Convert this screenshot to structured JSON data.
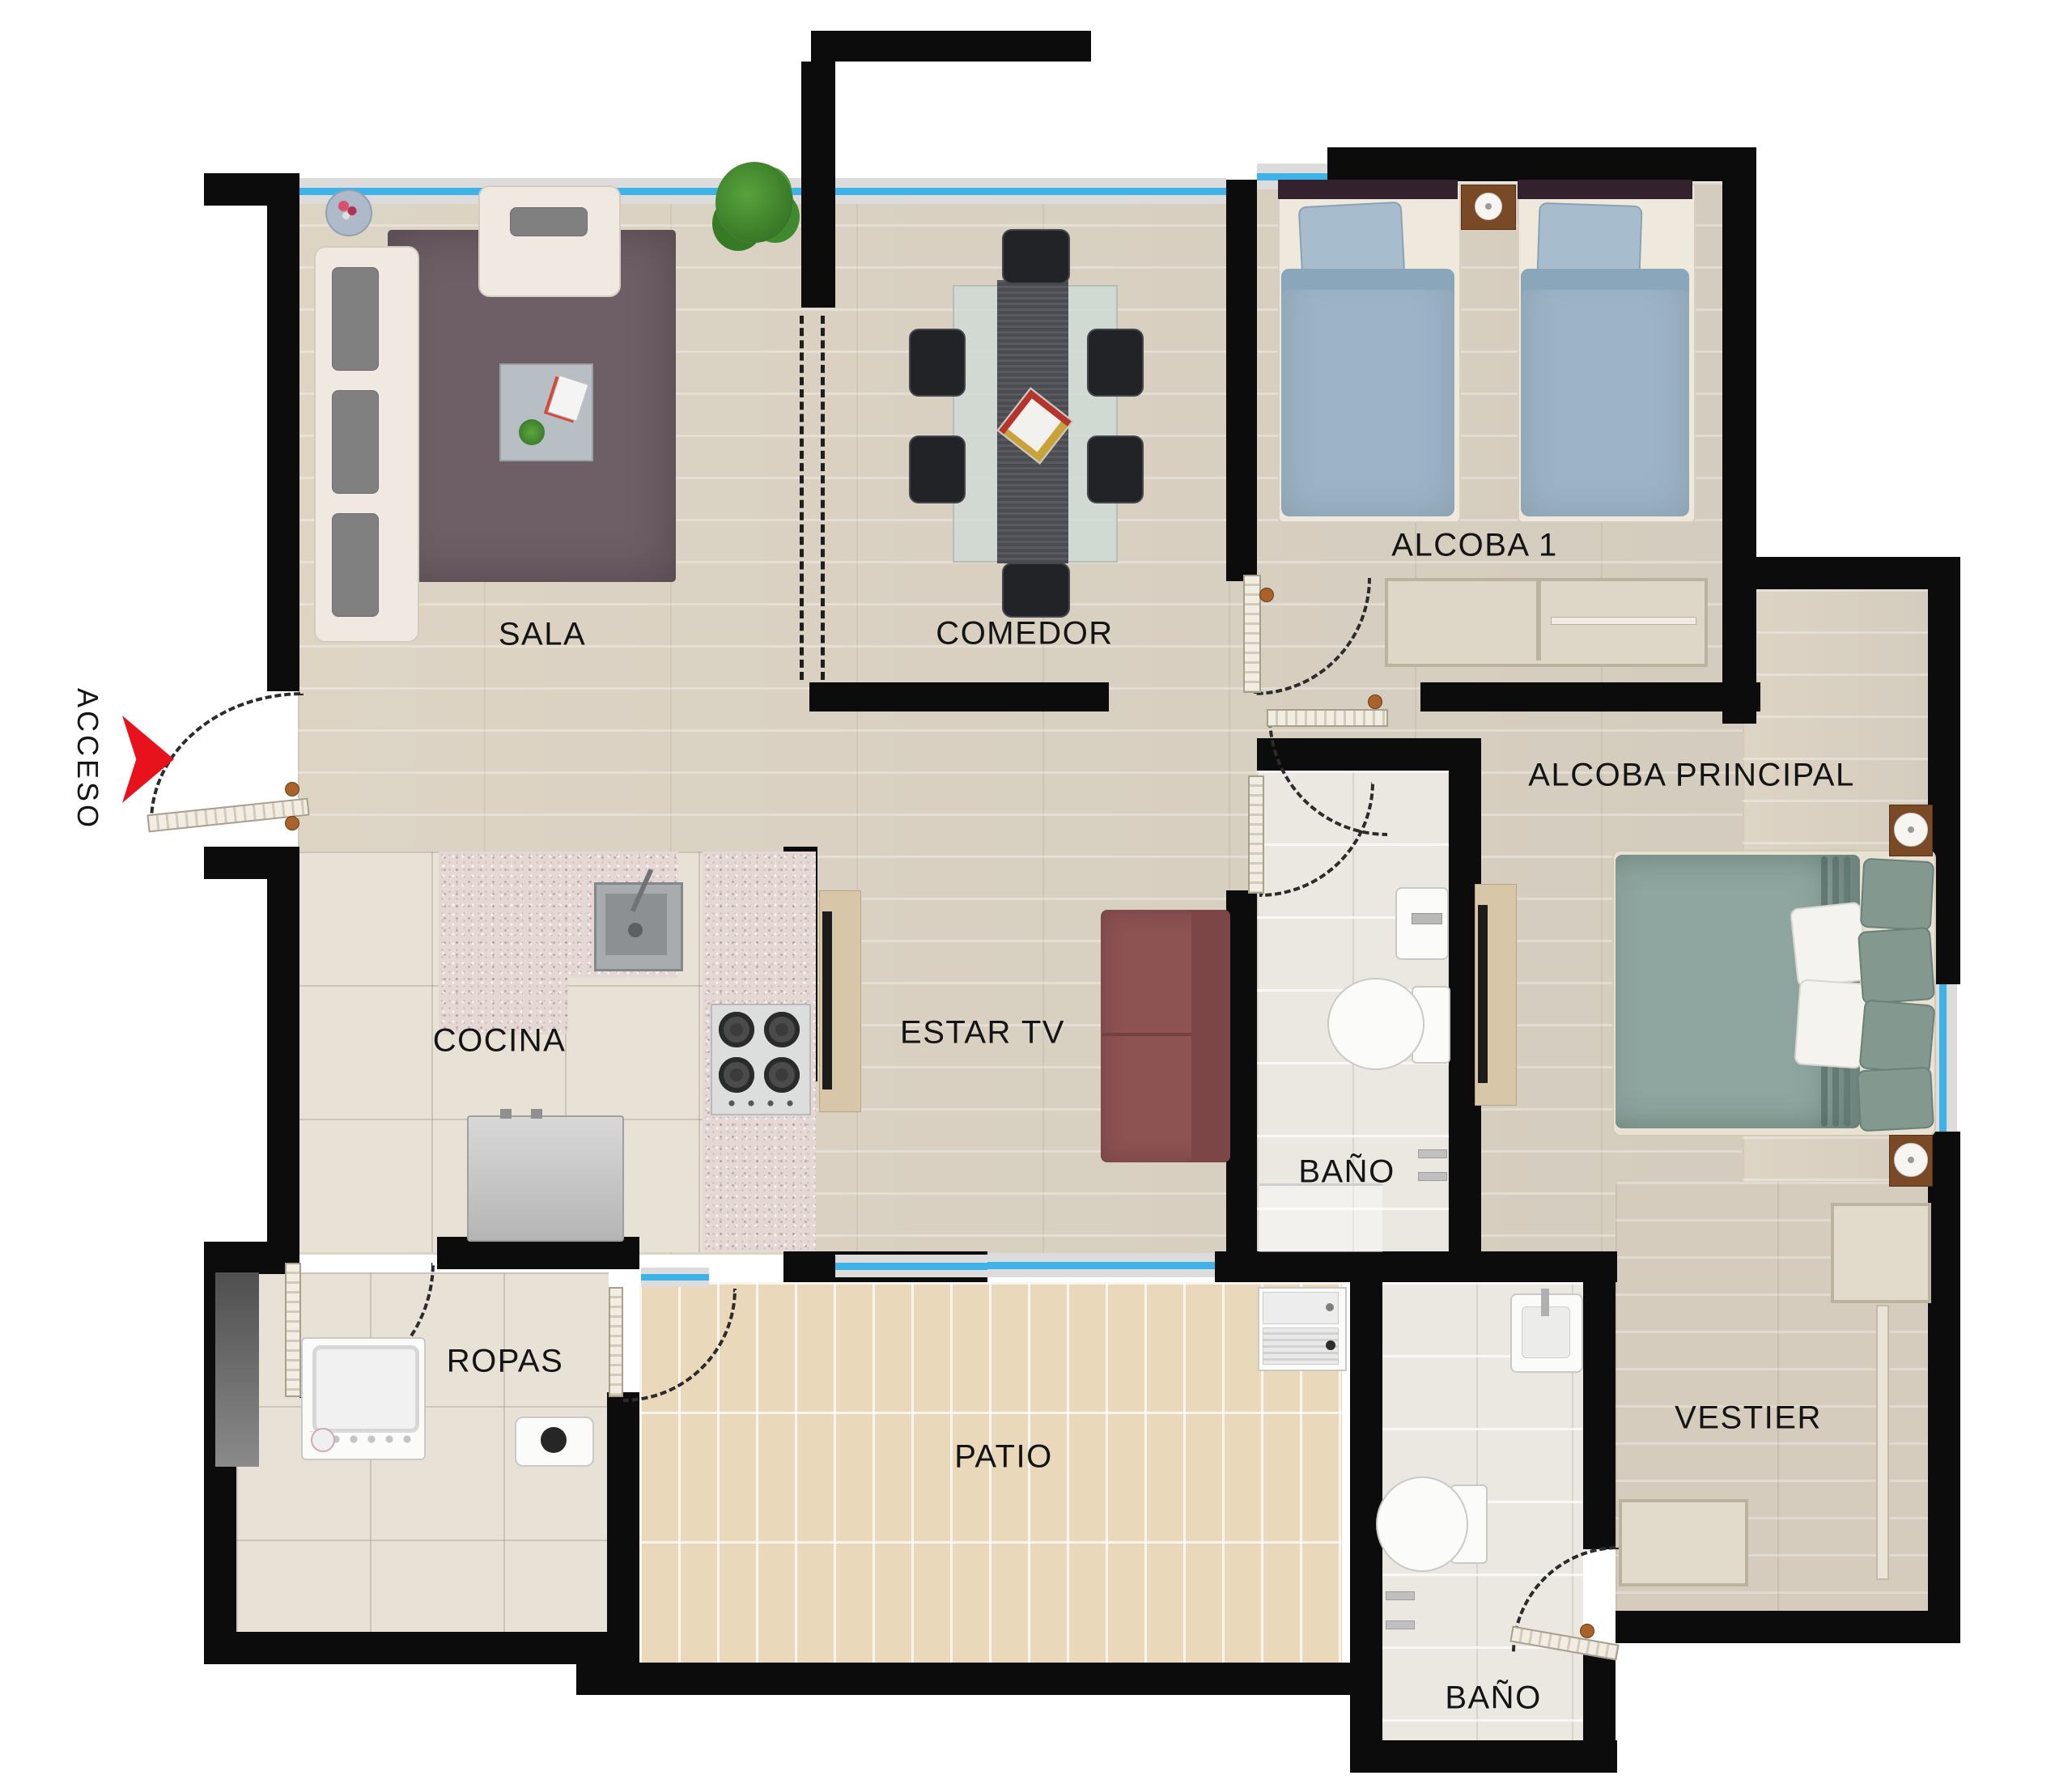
{
  "plan": {
    "type": "apartment-floor-plan",
    "access": {
      "label": "ACCESO"
    },
    "rooms": {
      "sala": {
        "label": "SALA"
      },
      "comedor": {
        "label": "COMEDOR"
      },
      "alcoba1": {
        "label": "ALCOBA 1"
      },
      "alcoba_principal": {
        "label": "ALCOBA PRINCIPAL"
      },
      "cocina": {
        "label": "COCINA"
      },
      "estar_tv": {
        "label": "ESTAR TV"
      },
      "bano_social": {
        "label": "BAÑO"
      },
      "ropas": {
        "label": "ROPAS"
      },
      "patio": {
        "label": "PATIO"
      },
      "bano_principal": {
        "label": "BAÑO"
      },
      "vestier": {
        "label": "VESTIER"
      }
    },
    "furniture": {
      "sala": [
        "sofa-3-seat",
        "armchair",
        "rug",
        "coffee-table",
        "side-table",
        "plant"
      ],
      "comedor": [
        "dining-table",
        "table-runner",
        "centerpiece",
        "chair",
        "chair",
        "chair",
        "chair",
        "chair",
        "chair",
        "plant"
      ],
      "alcoba1": [
        "single-bed",
        "single-bed",
        "nightstand",
        "lamp",
        "closet"
      ],
      "alcoba_principal": [
        "double-bed",
        "pillows",
        "nightstand",
        "nightstand",
        "lamp",
        "lamp",
        "tv-console",
        "tv"
      ],
      "cocina": [
        "granite-counter",
        "kitchen-sink",
        "stove-4-burners",
        "refrigerator"
      ],
      "estar_tv": [
        "sofa",
        "tv-console",
        "tv"
      ],
      "bano_social": [
        "washbasin",
        "toilet",
        "shower",
        "towel-bars"
      ],
      "ropas": [
        "washing-machine",
        "water-heater",
        "duct-shaft"
      ],
      "patio": [
        "laundry-sink"
      ],
      "bano_principal": [
        "washbasin",
        "toilet",
        "towel-bars"
      ],
      "vestier": [
        "wardrobe",
        "closet-rail",
        "wardrobe"
      ]
    },
    "colors": {
      "wall": "#0c0c0c",
      "window_glass": "#3fb3e8",
      "access_arrow": "#e8121c",
      "wood_floor": "#d9d0c0",
      "kitchen_tile": "#e8e1d6",
      "patio_tile": "#e9d9ba",
      "rug": "#6e5e65",
      "sofa_cream": "#efe9e1",
      "sofa_maroon": "#8d5252",
      "bed_blue": "#9cb4c6",
      "bed_teal": "#8ea69f",
      "granite": "#e5d8d4",
      "label_text": "#141414"
    }
  }
}
